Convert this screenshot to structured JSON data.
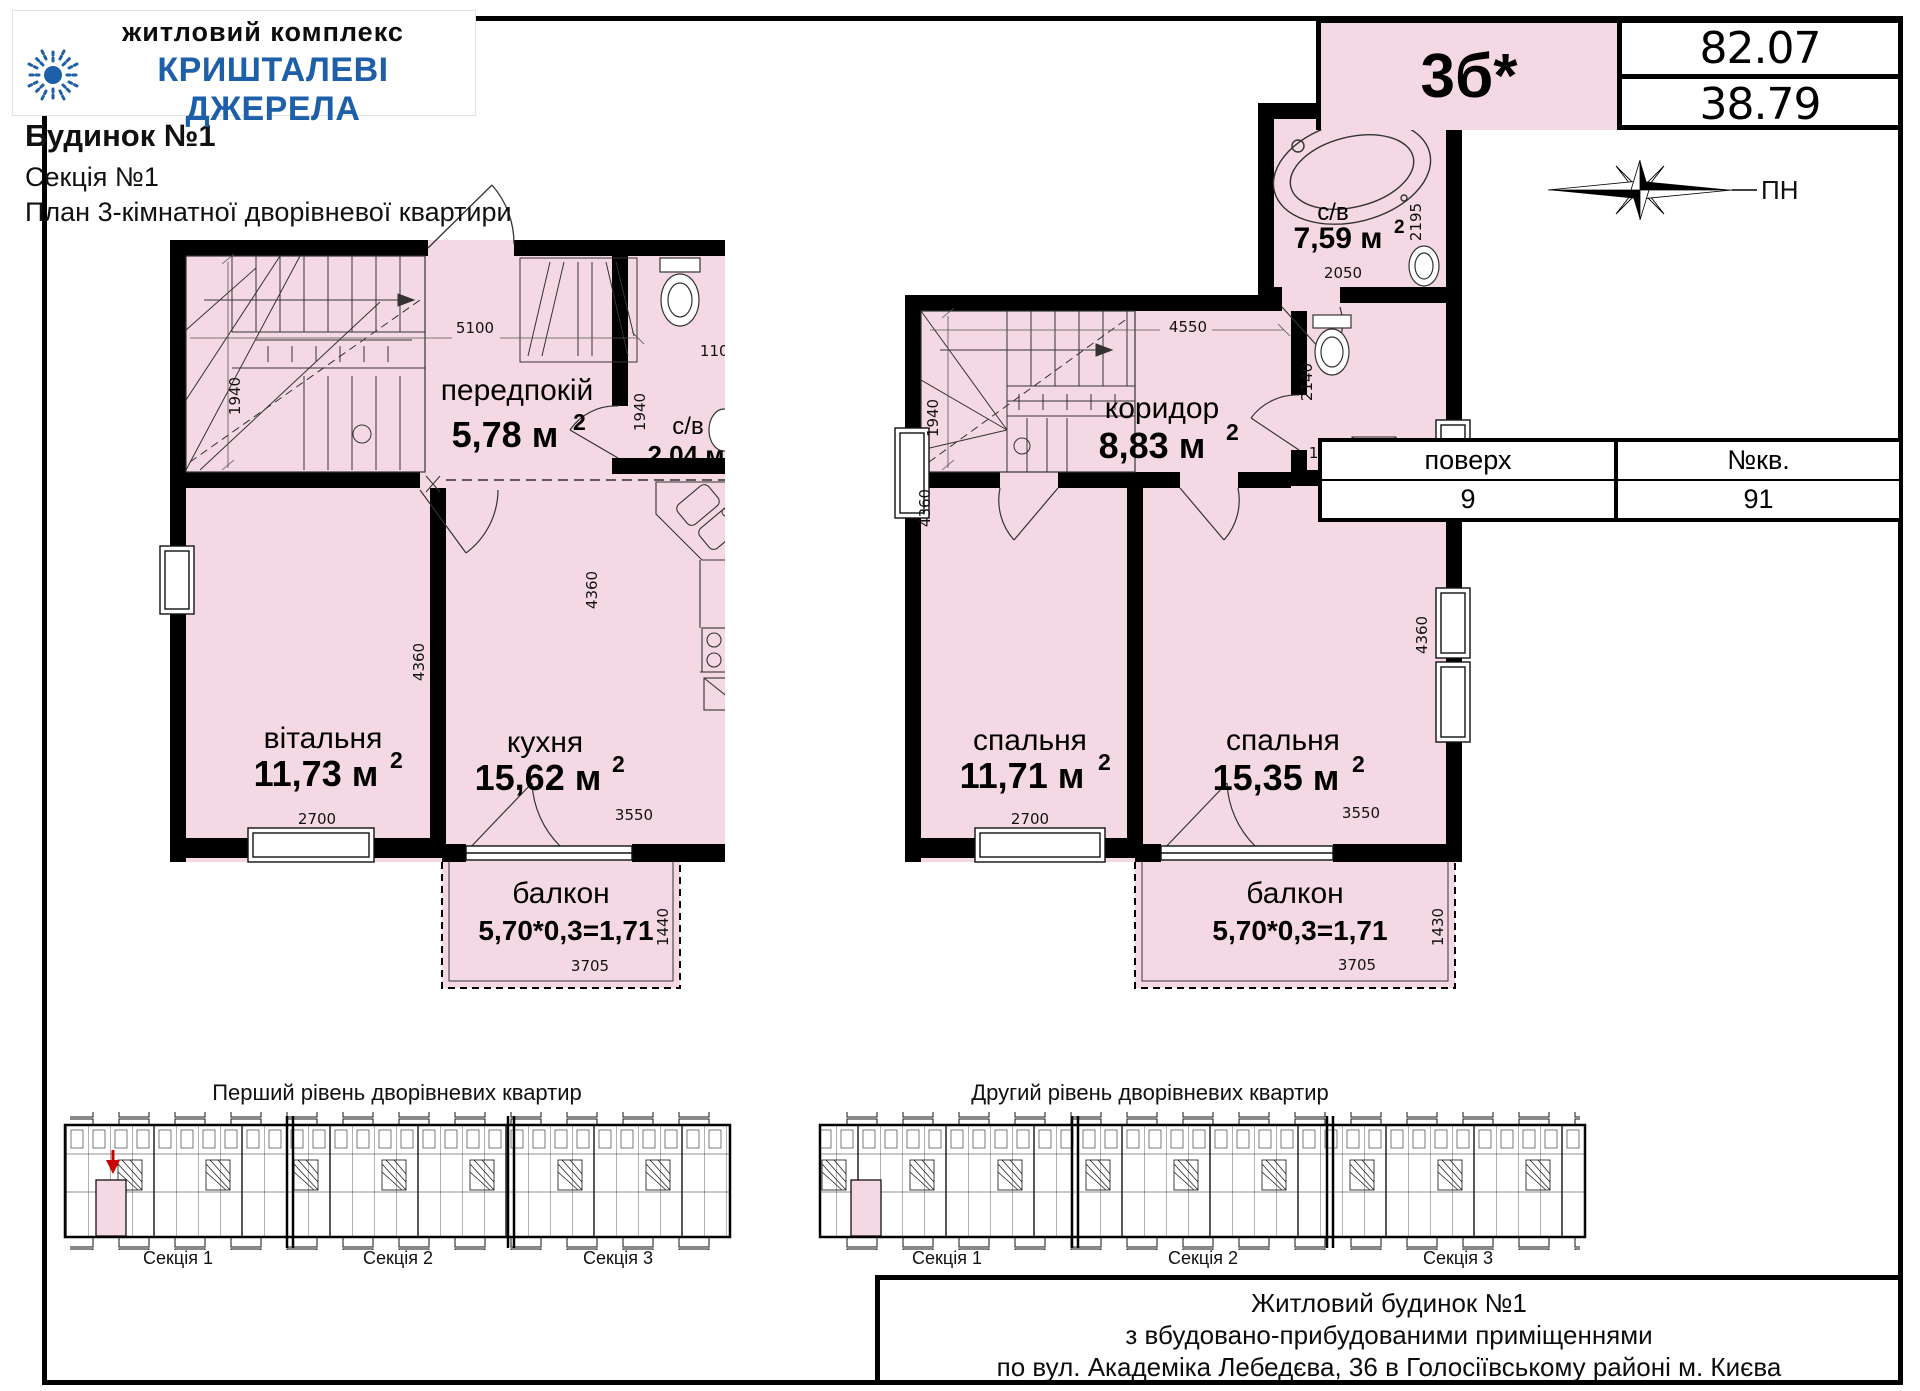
{
  "colors": {
    "pink": "#f4d9e4",
    "logo_blue": "#1d5fa8",
    "marker_red": "#cc0000"
  },
  "logo": {
    "subtitle": "житловий комплекс",
    "name": "КРИШТАЛЕВІ ДЖЕРЕЛА"
  },
  "header": {
    "building": "Будинок №1",
    "section": "Секція №1",
    "plan_title": "План 3-кімнатної дворівневої квартири"
  },
  "badge": {
    "unit_type": "3б*",
    "area_total": "82.07",
    "area_living": "38.79"
  },
  "compass": {
    "north": "ПН"
  },
  "floor_table": {
    "col_floor": "поверх",
    "col_apt": "№кв.",
    "floor": "9",
    "apt": "91"
  },
  "sup2": "2",
  "level1": {
    "hall_name": "передпокій",
    "hall_area": "5,78 м",
    "bath_name": "с/в",
    "bath_area": "2,04 м",
    "living_name": "вітальня",
    "living_area": "11,73 м",
    "kitchen_name": "кухня",
    "kitchen_area": "15,62 м",
    "balcony_name": "балкон",
    "balcony_area": "5,70*0,3=1,71",
    "dims": {
      "top": "5100",
      "stairs_h": "1940",
      "bath_w": "1100",
      "bath_pass": "1940",
      "living_w": "2700",
      "living_h": "4360",
      "kitchen_w": "3550",
      "kitchen_h": "4360",
      "balcony_w": "3705",
      "balcony_h": "1440"
    }
  },
  "level2": {
    "bath_name": "с/в",
    "bath_area": "7,59 м",
    "corridor_name": "коридор",
    "corridor_area": "8,83 м",
    "bed1_name": "спальня",
    "bed1_area": "11,71 м",
    "bed2_name": "спальня",
    "bed2_area": "15,35 м",
    "balcony_name": "балкон",
    "balcony_area": "5,70*0,3=1,71",
    "dims": {
      "top": "4550",
      "stairs_h": "1940",
      "bath_w": "2050",
      "bath_h": "2195",
      "wc_h": "2140",
      "wc_w": "1650",
      "bed1_w": "2700",
      "bed1_h": "4360",
      "bed2_w": "3550",
      "bed2_h": "4360",
      "balcony_w": "3705",
      "balcony_h": "1430"
    }
  },
  "overview": {
    "first": {
      "title": "Перший рівень дворівневих квартир",
      "s1": "Секція 1",
      "s2": "Секція 2",
      "s3": "Секція 3"
    },
    "second": {
      "title": "Другий рівень дворівневих квартир",
      "s1": "Секція 1",
      "s2": "Секція 2",
      "s3": "Секція 3"
    }
  },
  "title_block": {
    "line1": "Житловий будинок №1",
    "line2": "з вбудовано-прибудованими приміщеннями",
    "line3": "по вул. Академіка Лебедєва, 36 в Голосіївському районі м. Києва"
  }
}
